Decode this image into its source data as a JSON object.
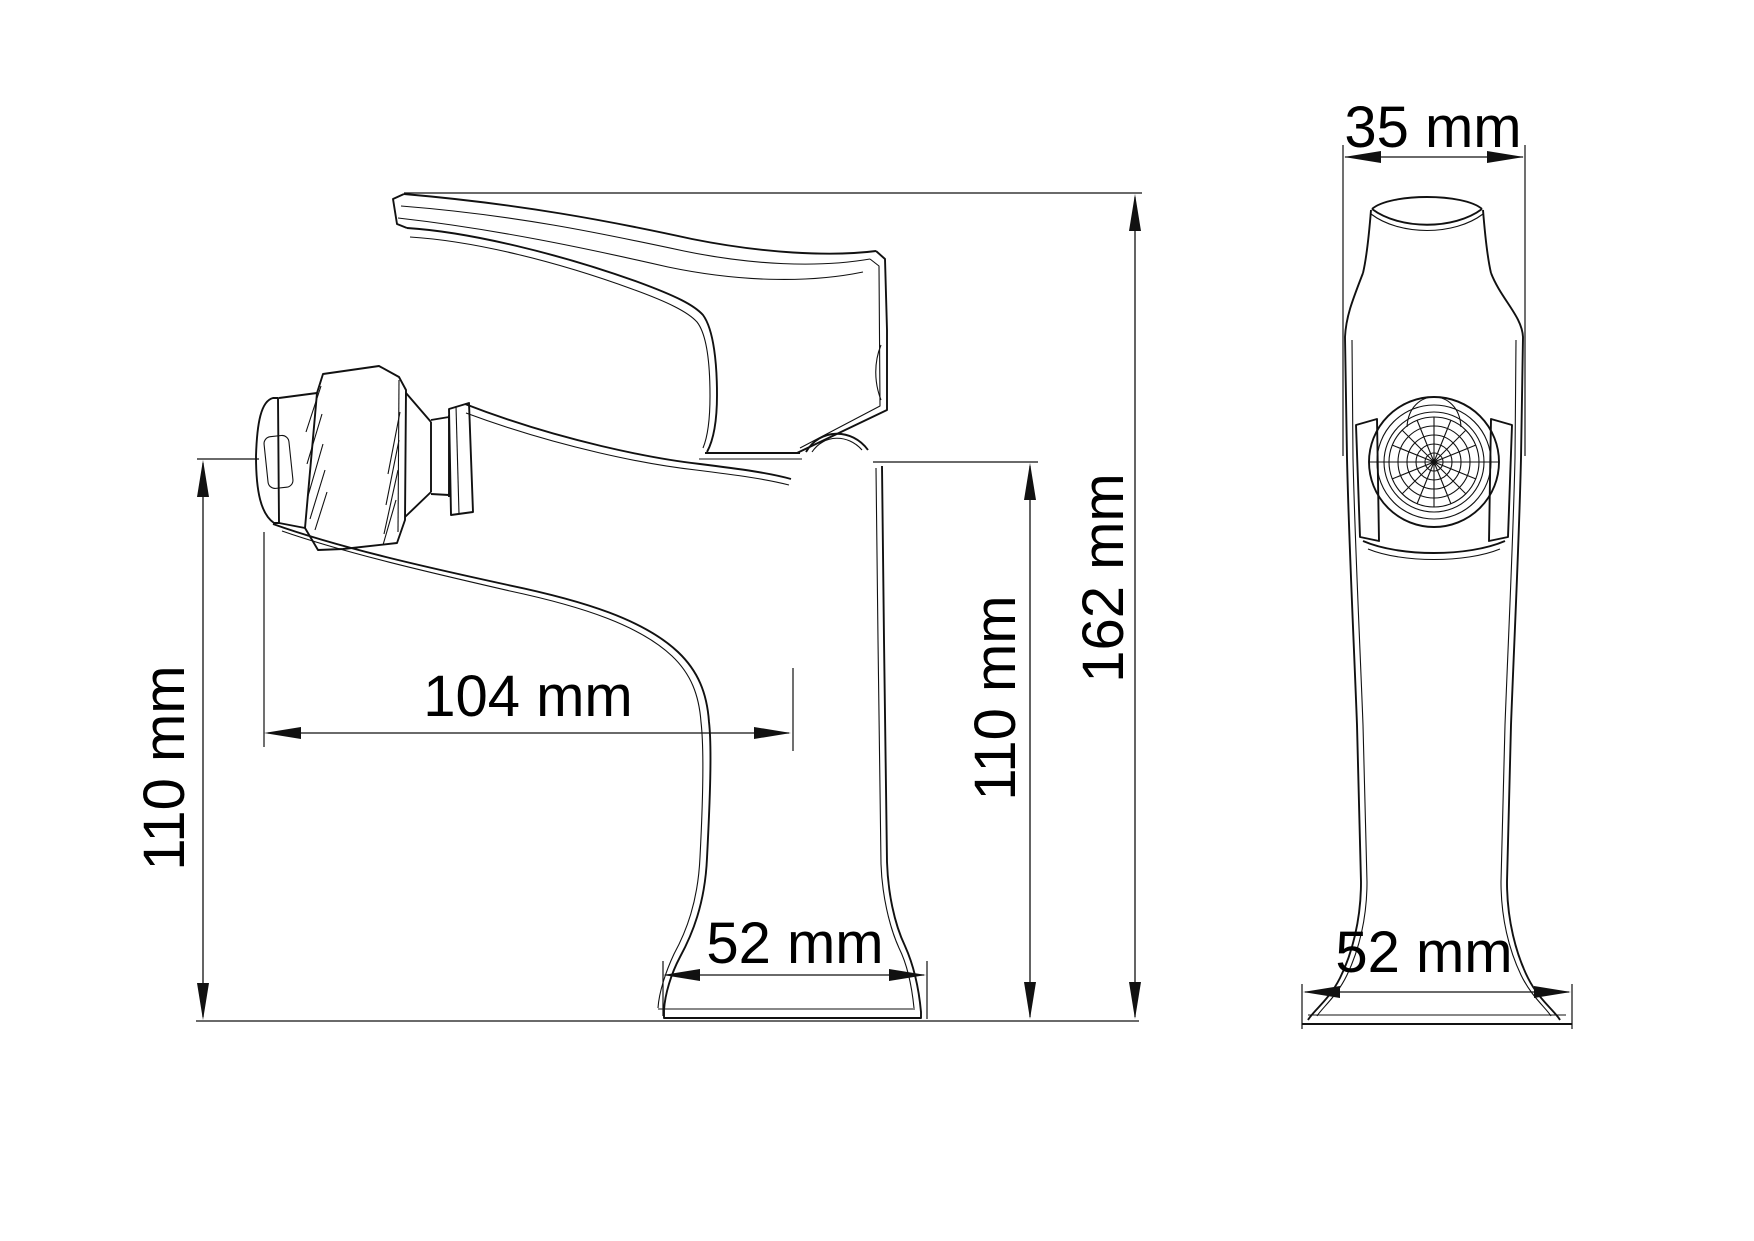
{
  "page": {
    "title": "Single-lever bidet mixer technical drawing",
    "background": "#ffffff",
    "line_color": "#111111"
  },
  "views": {
    "side": {
      "name": "side-view",
      "dimensions": {
        "spout_height_left": {
          "label": "110 mm",
          "orientation": "vertical"
        },
        "spout_reach": {
          "label": "104 mm",
          "orientation": "horizontal"
        },
        "body_height_right": {
          "label": "110 mm",
          "orientation": "vertical"
        },
        "total_height": {
          "label": "162 mm",
          "orientation": "vertical"
        },
        "base_width": {
          "label": "52 mm",
          "orientation": "horizontal"
        }
      }
    },
    "front": {
      "name": "front-view",
      "dimensions": {
        "top_width": {
          "label": "35 mm",
          "orientation": "horizontal"
        },
        "base_width": {
          "label": "52 mm",
          "orientation": "horizontal"
        }
      }
    }
  }
}
